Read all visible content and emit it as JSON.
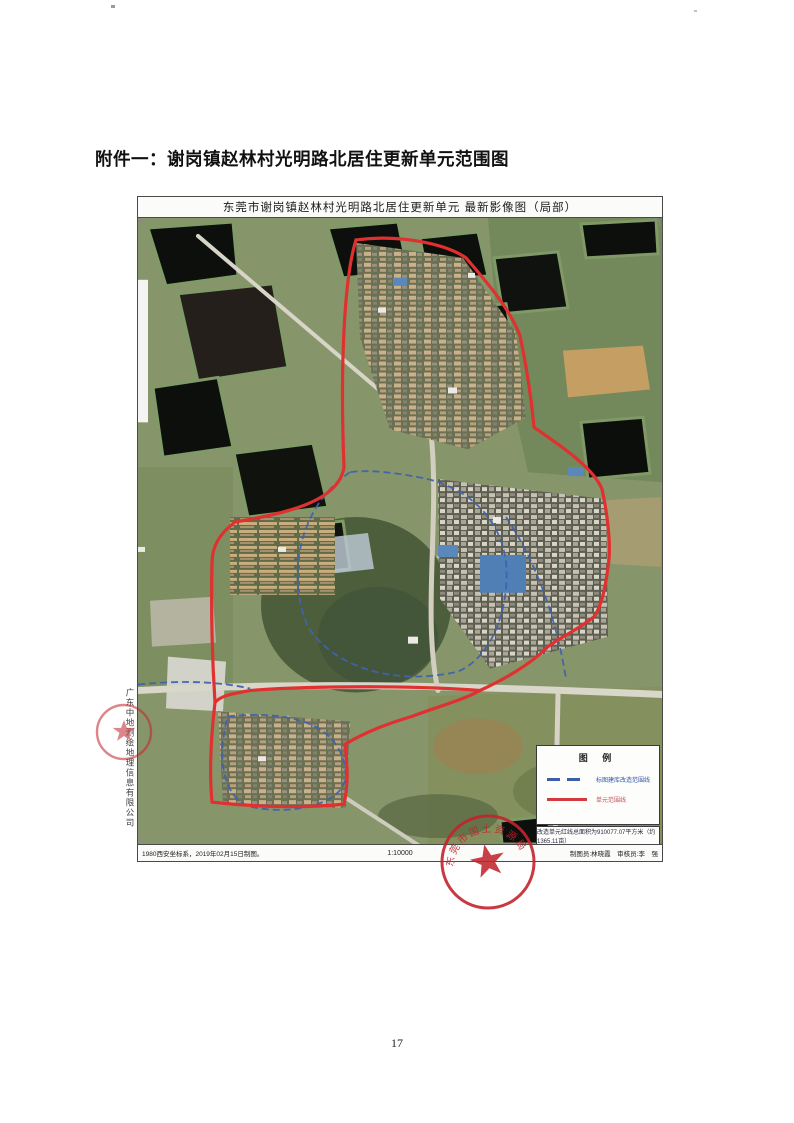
{
  "document": {
    "attachment_title": "附件一：谢岗镇赵林村光明路北居住更新单元范围图",
    "page_number": "17"
  },
  "map": {
    "title": "东莞市谢岗镇赵林村光明路北居住更新单元  最新影像图（局部）",
    "side_company": "广东中地测绘地理信息有限公司",
    "legend": {
      "title": "图    例",
      "items": [
        {
          "name": "renovation-mapping-line",
          "label": "标图建库改造范围线",
          "line_style": "dashed",
          "color": "#3a5fa8"
        },
        {
          "name": "unit-boundary-line",
          "label": "单元范围线",
          "line_style": "solid",
          "color": "#d43a3a"
        }
      ],
      "area_note": "改造单元红线总面积为910077.07平方米（约1365.11亩）"
    },
    "footer": {
      "coordinate_note": "1980西安坐标系，2019年02月15日制图。",
      "scale": "1:10000",
      "credits": "制图员:林晓霞　审核员:李　强"
    },
    "seal_text": "东莞市国土资源局"
  },
  "colors": {
    "boundary_red": "#e03030",
    "boundary_blue": "#3f62b0",
    "seal_red": "#c2242c"
  }
}
